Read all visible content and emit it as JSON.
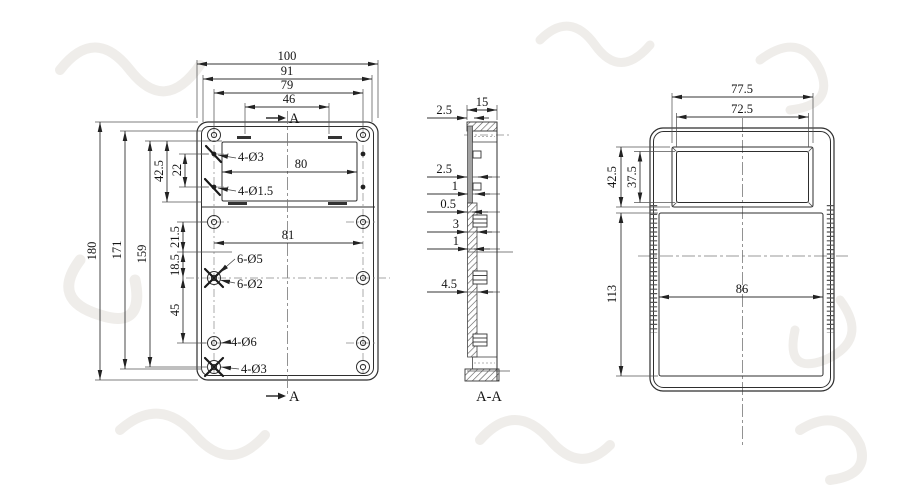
{
  "front": {
    "dims_top": {
      "w100": "100",
      "w91": "91",
      "w79": "79",
      "w46": "46"
    },
    "dims_left": {
      "h180": "180",
      "h171": "171",
      "h159": "159",
      "h42_5": "42.5",
      "h22": "22",
      "h21_5": "21.5",
      "h18_5": "18.5",
      "h45": "45"
    },
    "dims_inner": {
      "w80": "80",
      "w81": "81"
    },
    "callouts": {
      "top_holes": "4-Ø3",
      "top_small_holes": "4-Ø1.5",
      "mid_holes": "6-Ø5",
      "mid_small_holes": "6-Ø2",
      "bottom_holes": "4-Ø6",
      "bottom_corner_holes": "4-Ø3"
    },
    "section_marker_top": "A",
    "section_marker_bottom": "A"
  },
  "section": {
    "label": "A-A",
    "dims": {
      "w15": "15",
      "t2_5_top": "2.5",
      "t2_5": "2.5",
      "t1_upper": "1",
      "t0_5": "0.5",
      "t3": "3",
      "t1_lower": "1",
      "t4_5": "4.5"
    }
  },
  "side": {
    "dims": {
      "w77_5": "77.5",
      "w72_5": "72.5",
      "h42_5": "42.5",
      "h37_5": "37.5",
      "h113": "113",
      "w86": "86"
    }
  },
  "colors": {
    "background": "#ffffff",
    "line": "#2e2e2e",
    "dimension": "#333333",
    "text": "#141414",
    "watermark": "#efedea"
  }
}
